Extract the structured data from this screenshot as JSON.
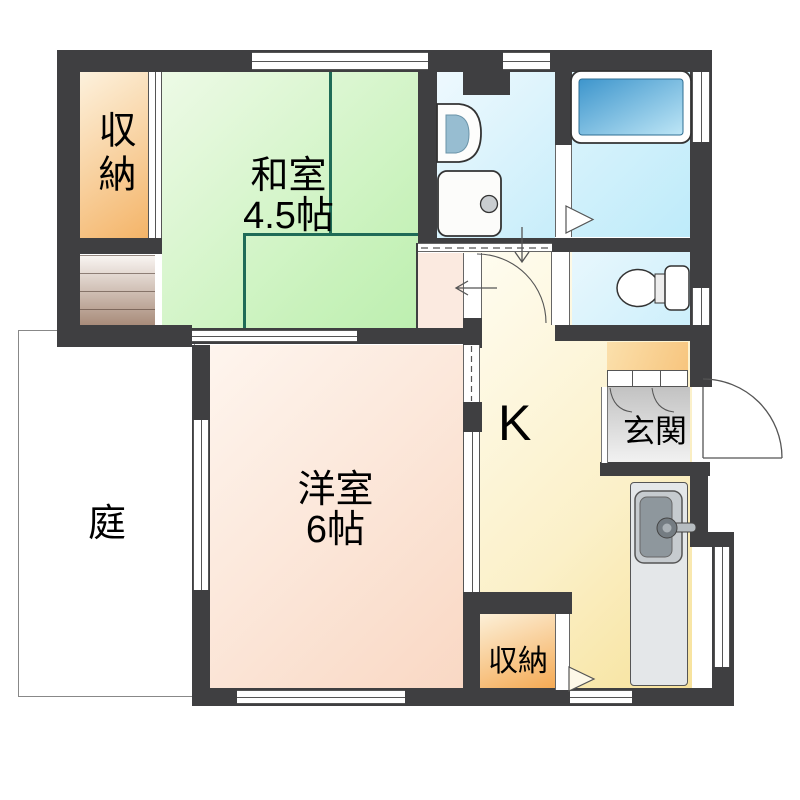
{
  "title": "Japanese apartment floor plan",
  "rooms": {
    "storage_top_left": {
      "label": "収納"
    },
    "japanese_room": {
      "label": "和室",
      "size": "4.5帖"
    },
    "western_room": {
      "label": "洋室",
      "size": "6帖"
    },
    "garden": {
      "label": "庭"
    },
    "kitchen": {
      "label": "K"
    },
    "entrance": {
      "label": "玄関"
    },
    "storage_bottom": {
      "label": "収納"
    }
  },
  "fixtures": [
    "bathtub",
    "washbasin",
    "washing-machine",
    "toilet",
    "kitchen-sink",
    "shoe-cabinet",
    "stairs",
    "entry-door"
  ],
  "colors": {
    "wall": "#3F3F41",
    "tatami_line": "#1F6B57",
    "japanese_room_fill": "#C8F2BB",
    "western_room_fill": "#F9D8C4",
    "kitchen_fill": "#FBF0C8",
    "storage_fill": "#F4B468",
    "entrance_floor": "#D9D9D9",
    "bath_fill": "#BEEBFA",
    "water_area_fill": "#C6EDFA",
    "bathtub_fill": "#3D95CC",
    "garden_fill": "#FFFFFF"
  }
}
